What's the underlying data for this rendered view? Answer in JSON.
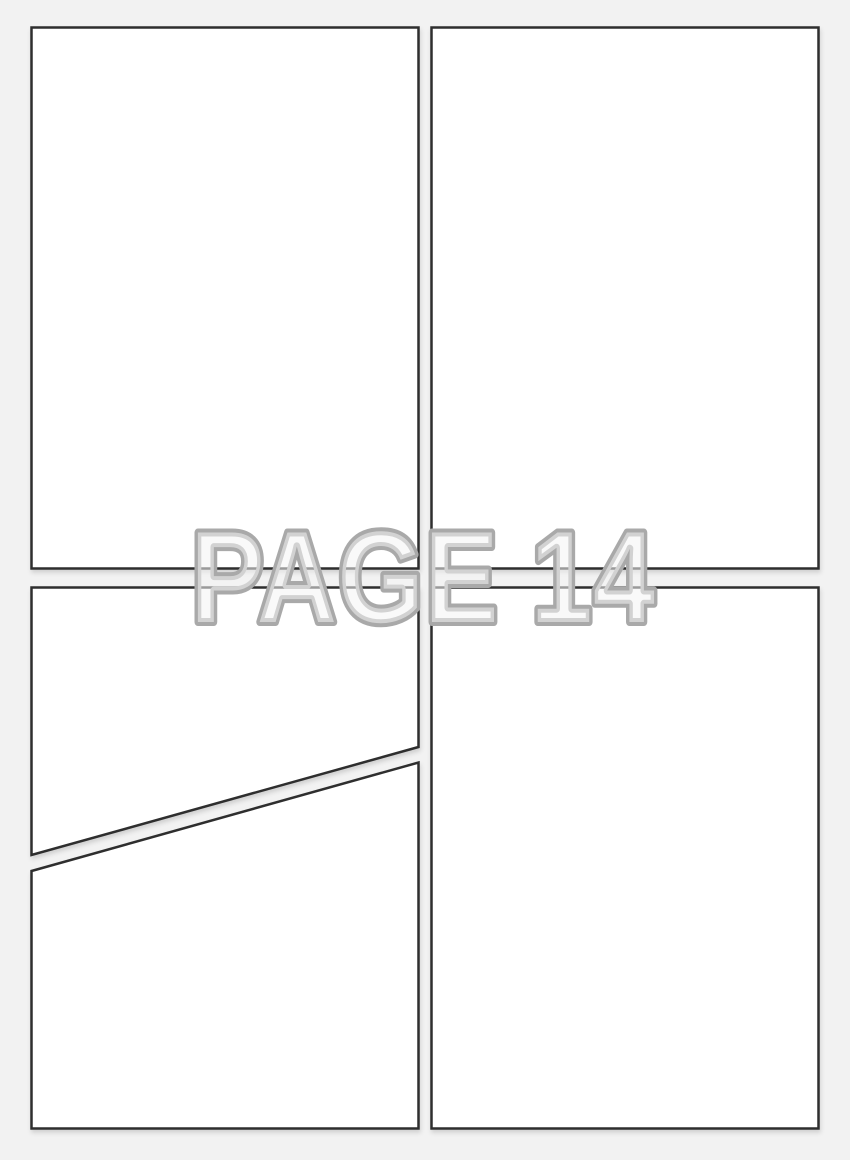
{
  "page": {
    "watermark": "PAGE 14",
    "colors": {
      "page-bg": "#f2f2f2",
      "panel-fill": "#ffffff",
      "panel-border": "#2f2f2f",
      "watermark-outline": "#a9a9a9",
      "watermark-fill": "#f4f4f4"
    },
    "panels": [
      {
        "id": "panel-top-left",
        "shape": "rect",
        "x": 31.5,
        "y": 27.5,
        "width": 387,
        "height": 541
      },
      {
        "id": "panel-top-right",
        "shape": "rect",
        "x": 431.5,
        "y": 27.5,
        "width": 387,
        "height": 541
      },
      {
        "id": "panel-bottom-left-upper",
        "shape": "polygon",
        "points": "31.5,587.5 418.5,587.5 418.5,747 31.5,855"
      },
      {
        "id": "panel-bottom-left-lower",
        "shape": "polygon",
        "points": "31.5,871 418.5,762.5 418.5,1128.5 31.5,1128.5"
      },
      {
        "id": "panel-bottom-right",
        "shape": "rect",
        "x": 431.5,
        "y": 587.5,
        "width": 387,
        "height": 541
      }
    ]
  }
}
